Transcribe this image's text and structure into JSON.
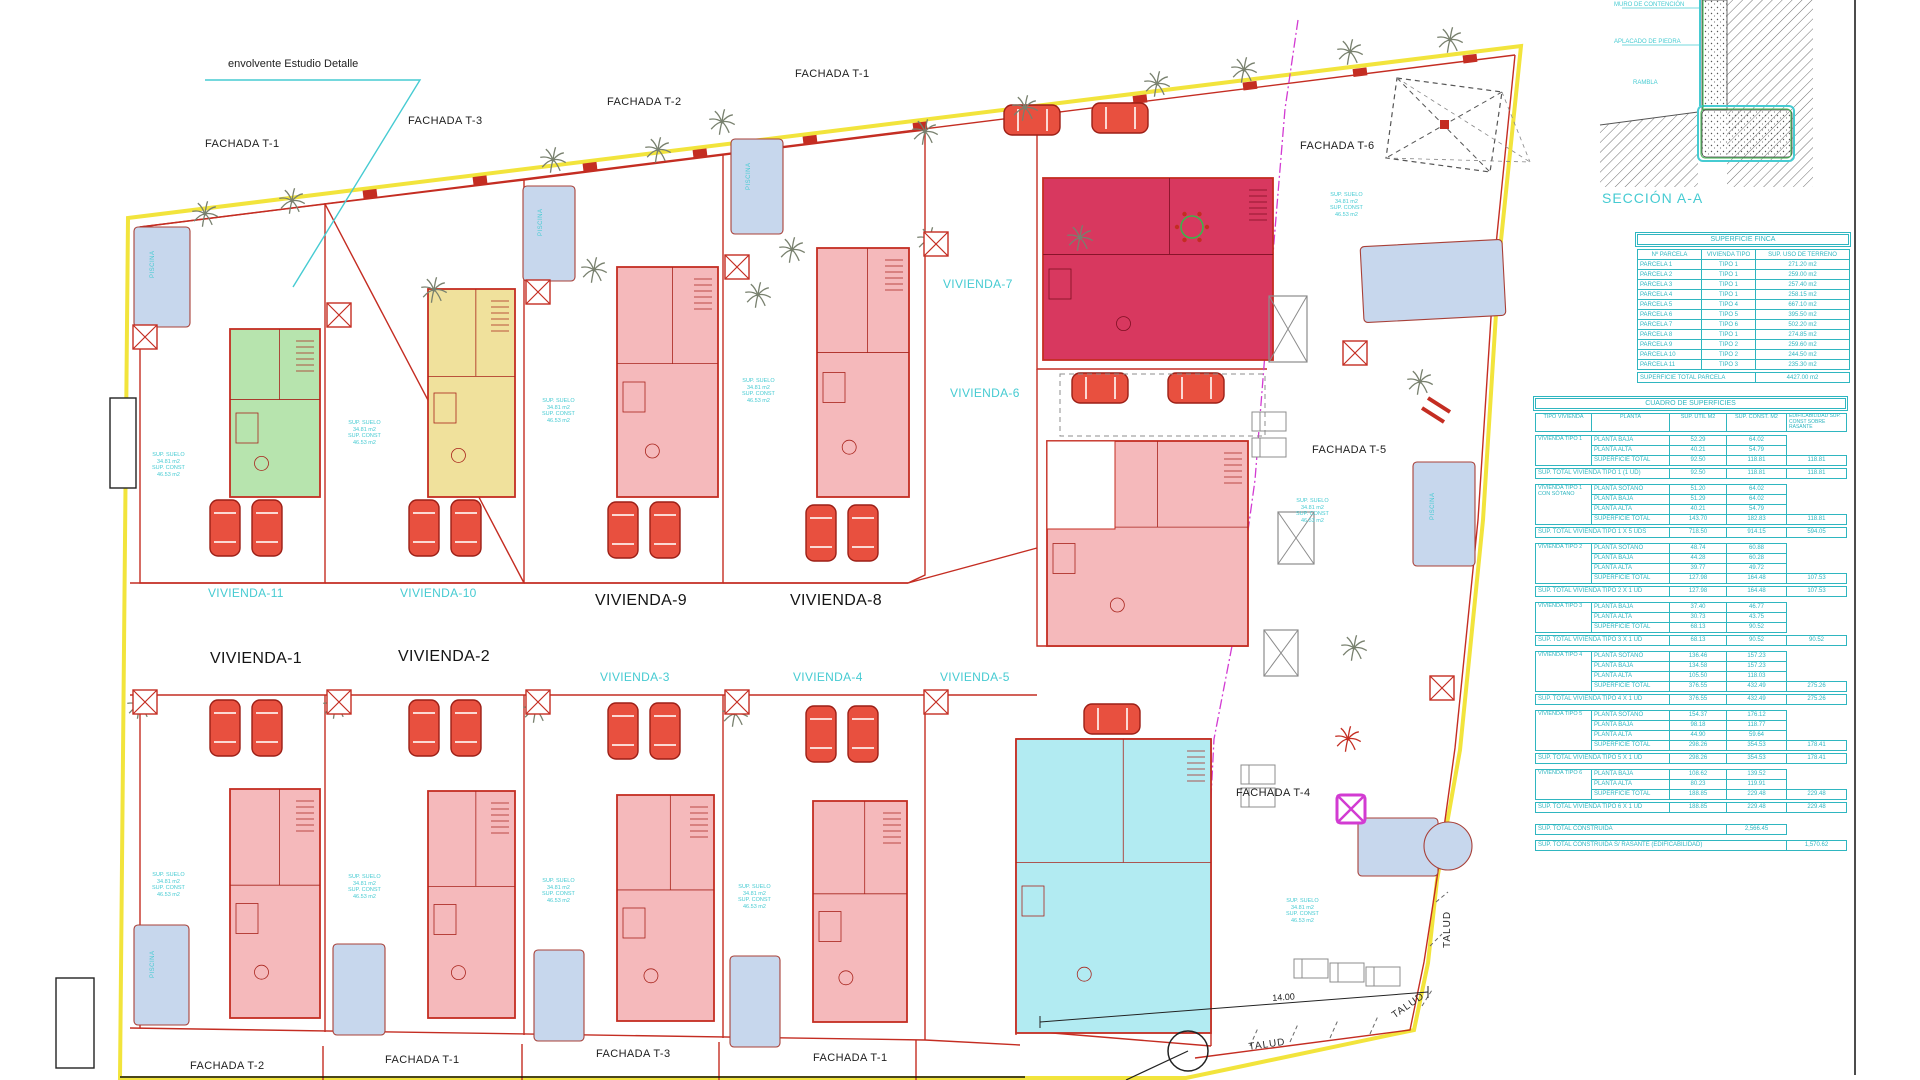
{
  "colors": {
    "red": "#c42d22",
    "dark_red": "#a8241c",
    "yellow_boundary": "#f2e43c",
    "cyan": "#46cbd2",
    "table_cyan": "#2fb6c0",
    "magenta": "#d23bd2",
    "pink_house": "#f5b9bb",
    "green_house": "#b7e4ae",
    "yellow_house": "#f0e19c",
    "crimson_house": "#d8385f",
    "cyan_house": "#b2ebf2",
    "pool_blue": "#c7d7ed",
    "gray": "#8c8c8c",
    "black": "#1c1c1c"
  },
  "labels": {
    "envolvente": "envolvente Estudio Detalle",
    "fachadas": {
      "t1_topleft": "FACHADA T-1",
      "t3_top": "FACHADA T-3",
      "t2_top": "FACHADA T-2",
      "t1_top": "FACHADA T-1",
      "t6": "FACHADA T-6",
      "t5": "FACHADA T-5",
      "t4": "FACHADA T-4",
      "t2_bottom": "FACHADA T-2",
      "t1_bottom_left": "FACHADA T-1",
      "t3_bottom": "FACHADA T-3",
      "t1_bottom_right": "FACHADA T-1"
    },
    "viviendas": {
      "v1": "VIVIENDA-1",
      "v2": "VIVIENDA-2",
      "v3": "VIVIENDA-3",
      "v4": "VIVIENDA-4",
      "v5": "VIVIENDA-5",
      "v6": "VIVIENDA-6",
      "v7": "VIVIENDA-7",
      "v8": "VIVIENDA-8",
      "v9": "VIVIENDA-9",
      "v10": "VIVIENDA-10",
      "v11": "VIVIENDA-11"
    },
    "talud": "TALUD",
    "dim_14": "14.00",
    "piscina": "PISCINA",
    "annotation": {
      "line1": "SUP. SUELO",
      "line2": "34.81 m2",
      "line3": "SUP. CONST",
      "line4": "46.53 m2"
    }
  },
  "section": {
    "title": "SECCIÓN A-A",
    "label_muro": "MURO DE CONTENCIÓN",
    "label_aplacado": "APLACADO DE PIEDRA",
    "label_rambla": "RAMBLA"
  },
  "tables": {
    "finca": {
      "title": "SUPERFICIE FINCA",
      "headers": [
        "Nº PARCELA",
        "VIVIENDA TIPO",
        "SUP. USO DE TERRENO"
      ],
      "rows": [
        [
          "PARCELA 1",
          "TIPO 1",
          "271.20 m2"
        ],
        [
          "PARCELA 2",
          "TIPO 1",
          "259.00 m2"
        ],
        [
          "PARCELA 3",
          "TIPO 1",
          "257.40 m2"
        ],
        [
          "PARCELA 4",
          "TIPO 1",
          "258.15 m2"
        ],
        [
          "PARCELA 5",
          "TIPO 4",
          "667.10 m2"
        ],
        [
          "PARCELA 6",
          "TIPO 5",
          "395.50 m2"
        ],
        [
          "PARCELA 7",
          "TIPO 6",
          "502.20 m2"
        ],
        [
          "PARCELA 8",
          "TIPO 1",
          "274.85 m2"
        ],
        [
          "PARCELA 9",
          "TIPO 2",
          "259.60 m2"
        ],
        [
          "PARCELA 10",
          "TIPO 2",
          "244.50 m2"
        ],
        [
          "PARCELA 11",
          "TIPO 3",
          "235.30 m2"
        ]
      ],
      "total_label": "SUPERFICIE TOTAL PARCELA",
      "total_value": "4427.00 m2"
    },
    "cuadro": {
      "title": "CUADRO DE SUPERFICIES",
      "headers": [
        "TIPO VIVIENDA",
        "PLANTA",
        "SUP. ÚTIL M2",
        "SUP. CONST. M2"
      ],
      "note": "EDIFICABILIDAD SUP. CONST SOBRE RASANTE",
      "groups": [
        {
          "tipo": "VIVIENDA TIPO 1",
          "rows": [
            [
              "PLANTA BAJA",
              "52.29",
              "64.02",
              ""
            ],
            [
              "PLANTA ALTA",
              "40.21",
              "54.79",
              ""
            ],
            [
              "SUPERFICIE TOTAL",
              "92.50",
              "118.81",
              "118.81"
            ]
          ],
          "total": [
            "SUP. TOTAL VIVIENDA TIPO 1 (1 UD)",
            "92.50",
            "118.81",
            "118.81"
          ]
        },
        {
          "tipo": "VIVIENDA TIPO 1 CON SÓTANO",
          "rows": [
            [
              "PLANTA SÓTANO",
              "51.20",
              "64.02",
              ""
            ],
            [
              "PLANTA BAJA",
              "51.29",
              "64.02",
              ""
            ],
            [
              "PLANTA ALTA",
              "40.21",
              "54.79",
              ""
            ],
            [
              "SUPERFICIE TOTAL",
              "143.70",
              "182.83",
              "118.81"
            ]
          ],
          "total": [
            "SUP. TOTAL VIVIENDA TIPO 1 X 5 UDS",
            "718.50",
            "914.15",
            "594.05"
          ]
        },
        {
          "tipo": "VIVIENDA TIPO 2",
          "rows": [
            [
              "PLANTA SÓTANO",
              "48.74",
              "60.88",
              ""
            ],
            [
              "PLANTA BAJA",
              "44.28",
              "60.28",
              ""
            ],
            [
              "PLANTA ALTA",
              "39.77",
              "49.72",
              ""
            ],
            [
              "SUPERFICIE TOTAL",
              "127.98",
              "164.48",
              "107.53"
            ]
          ],
          "total": [
            "SUP. TOTAL VIVIENDA TIPO 2 X 1 UD",
            "127.98",
            "164.48",
            "107.53"
          ]
        },
        {
          "tipo": "VIVIENDA TIPO 3",
          "rows": [
            [
              "PLANTA BAJA",
              "37.40",
              "46.77",
              ""
            ],
            [
              "PLANTA ALTA",
              "30.73",
              "43.75",
              ""
            ],
            [
              "SUPERFICIE TOTAL",
              "68.13",
              "90.52",
              ""
            ]
          ],
          "total": [
            "SUP. TOTAL VIVIENDA TIPO 3 X 1 UD",
            "68.13",
            "90.52",
            "90.52"
          ]
        },
        {
          "tipo": "VIVIENDA TIPO 4",
          "rows": [
            [
              "PLANTA SÓTANO",
              "136.46",
              "157.23",
              ""
            ],
            [
              "PLANTA BAJA",
              "134.58",
              "157.23",
              ""
            ],
            [
              "PLANTA ALTA",
              "105.50",
              "118.03",
              ""
            ],
            [
              "SUPERFICIE TOTAL",
              "376.55",
              "432.49",
              "275.26"
            ]
          ],
          "total": [
            "SUP. TOTAL VIVIENDA TIPO 4 X 1 UD",
            "376.55",
            "432.49",
            "275.26"
          ]
        },
        {
          "tipo": "VIVIENDA TIPO 5",
          "rows": [
            [
              "PLANTA SÓTANO",
              "154.37",
              "176.12",
              ""
            ],
            [
              "PLANTA BAJA",
              "98.18",
              "118.77",
              ""
            ],
            [
              "PLANTA ALTA",
              "44.90",
              "59.64",
              ""
            ],
            [
              "SUPERFICIE TOTAL",
              "298.26",
              "354.53",
              "178.41"
            ]
          ],
          "total": [
            "SUP. TOTAL VIVIENDA TIPO 5 X 1 UD",
            "298.26",
            "354.53",
            "178.41"
          ]
        },
        {
          "tipo": "VIVIENDA TIPO 6",
          "rows": [
            [
              "PLANTA BAJA",
              "108.62",
              "139.52",
              ""
            ],
            [
              "PLANTA ALTA",
              "80.23",
              "119.91",
              ""
            ],
            [
              "SUPERFICIE TOTAL",
              "188.85",
              "229.48",
              "229.48"
            ]
          ],
          "total": [
            "SUP. TOTAL VIVIENDA TIPO 6 X 1 UD",
            "188.85",
            "229.48",
            "229.48"
          ]
        }
      ],
      "footer": [
        {
          "label": "SUP. TOTAL CONSTRUIDA",
          "value": "2,566.45",
          "col": "const"
        },
        {
          "label": "SUP. TOTAL CONSTRUIDA S/ RASANTE (EDIFICABILIDAD)",
          "value": "1,570.62",
          "col": "edif"
        }
      ]
    }
  }
}
